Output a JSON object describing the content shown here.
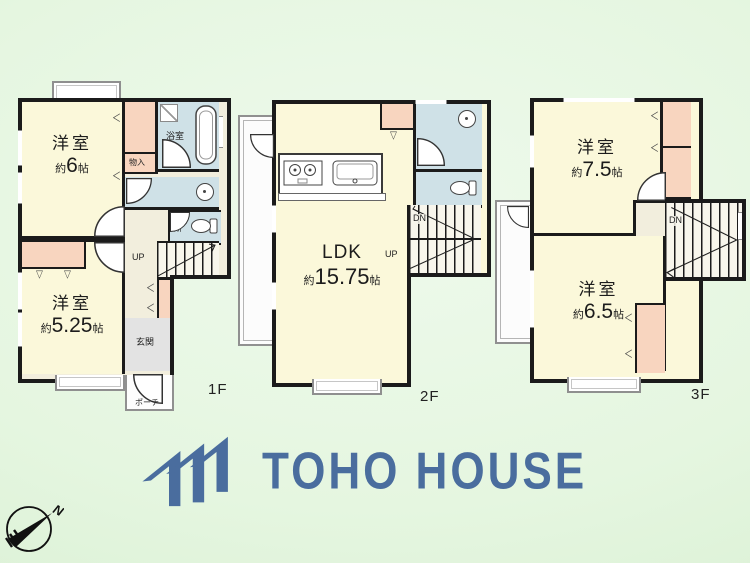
{
  "colors": {
    "background_green": "#e5f6e0",
    "wall": "#1b1b1b",
    "room_cream": "#fbf8da",
    "wet_area_blue": "#cfe1e7",
    "closet_pink": "#f8d5bf",
    "hall_beige": "#f2eedd",
    "entrance_gray": "#e3e3e3",
    "logo_blue": "#4a6d9e"
  },
  "floors": [
    {
      "label": "1F",
      "rooms": [
        {
          "name": "洋室",
          "size_prefix": "約",
          "size_value": "6",
          "size_unit": "帖"
        },
        {
          "name": "洋室",
          "size_prefix": "約",
          "size_value": "5.25",
          "size_unit": "帖"
        }
      ],
      "bath_label": "浴室",
      "storage_label": "物入",
      "toilet_label": "便所",
      "stairs_up_label": "UP",
      "entrance_label": "玄関",
      "porch_label": "ポーチ"
    },
    {
      "label": "2F",
      "ldk": {
        "name": "LDK",
        "size_prefix": "約",
        "size_value": "15.75",
        "size_unit": "帖"
      },
      "stairs_dn_label": "DN",
      "stairs_up_label": "UP"
    },
    {
      "label": "3F",
      "rooms": [
        {
          "name": "洋室",
          "size_prefix": "約",
          "size_value": "7.5",
          "size_unit": "帖"
        },
        {
          "name": "洋室",
          "size_prefix": "約",
          "size_value": "6.5",
          "size_unit": "帖"
        }
      ],
      "stairs_dn_label": "DN"
    }
  ],
  "logo": {
    "text": "TOHO HOUSE"
  },
  "compass": {
    "north_label": "N"
  },
  "symbols": {
    "fold_left": "＜",
    "fold_down": "▽"
  }
}
